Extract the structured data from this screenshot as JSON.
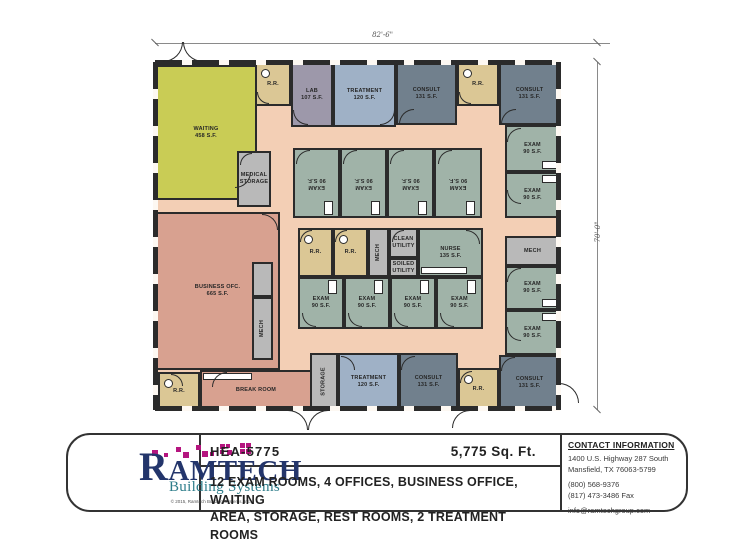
{
  "floor_plan": {
    "width_dimension": "82'-6\"",
    "height_dimension": "70'-0\"",
    "wall_color": "#2b2b2b",
    "palette": {
      "corridor": "#f3cfb5",
      "waiting": "#c9cc55",
      "office": "#d8a190",
      "exam": "#a0b3a8",
      "consult": "#71808d",
      "treatment": "#9fb1c6",
      "lab": "#9d98aa",
      "rr": "#dbc795",
      "util": "#b9b9b9"
    },
    "rooms": [
      {
        "id": "waiting",
        "type": "waiting",
        "label": [
          "WAITING",
          "458 S.F."
        ],
        "x": 155,
        "y": 65,
        "w": 102,
        "h": 135
      },
      {
        "id": "rr-entry",
        "type": "rr",
        "label": [
          "R.R."
        ],
        "x": 255,
        "y": 62,
        "w": 36,
        "h": 44,
        "fix": "wc"
      },
      {
        "id": "lab",
        "type": "lab",
        "label": [
          "LAB",
          "107 S.F."
        ],
        "x": 291,
        "y": 62,
        "w": 42,
        "h": 65
      },
      {
        "id": "treatment-top",
        "type": "treatment",
        "label": [
          "TREATMENT",
          "120 S.F."
        ],
        "x": 333,
        "y": 62,
        "w": 63,
        "h": 65
      },
      {
        "id": "consult-top-1",
        "type": "consult",
        "label": [
          "CONSULT",
          "131 S.F."
        ],
        "x": 396,
        "y": 62,
        "w": 61,
        "h": 63
      },
      {
        "id": "rr-top",
        "type": "rr",
        "label": [
          "R.R."
        ],
        "x": 457,
        "y": 62,
        "w": 42,
        "h": 44,
        "fix": "wc"
      },
      {
        "id": "consult-top-2",
        "type": "consult",
        "label": [
          "CONSULT",
          "131 S.F."
        ],
        "x": 499,
        "y": 62,
        "w": 61,
        "h": 63
      },
      {
        "id": "exam-right-1",
        "type": "exam",
        "label": [
          "EXAM",
          "90 S.F."
        ],
        "x": 505,
        "y": 125,
        "w": 55,
        "h": 47,
        "fix": "br"
      },
      {
        "id": "exam-right-2",
        "type": "exam",
        "label": [
          "EXAM",
          "90 S.F."
        ],
        "x": 505,
        "y": 172,
        "w": 55,
        "h": 46,
        "fix": "tr"
      },
      {
        "id": "mech-right",
        "type": "util",
        "label": [
          "MECH"
        ],
        "x": 505,
        "y": 236,
        "w": 55,
        "h": 30
      },
      {
        "id": "exam-right-3",
        "type": "exam",
        "label": [
          "EXAM",
          "90 S.F."
        ],
        "x": 505,
        "y": 266,
        "w": 55,
        "h": 44,
        "fix": "br"
      },
      {
        "id": "exam-right-4",
        "type": "exam",
        "label": [
          "EXAM",
          "90 S.F."
        ],
        "x": 505,
        "y": 310,
        "w": 55,
        "h": 45,
        "fix": "tr"
      },
      {
        "id": "consult-bottom-2",
        "type": "consult",
        "label": [
          "CONSULT",
          "131 S.F."
        ],
        "x": 499,
        "y": 355,
        "w": 61,
        "h": 55
      },
      {
        "id": "exam-1",
        "type": "exam",
        "label": [
          "EXAM",
          "90 S.F."
        ],
        "x": 293,
        "y": 148,
        "w": 47,
        "h": 70,
        "rot": 180,
        "fix": "bv"
      },
      {
        "id": "exam-2",
        "type": "exam",
        "label": [
          "EXAM",
          "90 S.F."
        ],
        "x": 340,
        "y": 148,
        "w": 47,
        "h": 70,
        "rot": 180,
        "fix": "bv"
      },
      {
        "id": "exam-3",
        "type": "exam",
        "label": [
          "EXAM",
          "90 S.F."
        ],
        "x": 387,
        "y": 148,
        "w": 47,
        "h": 70,
        "rot": 180,
        "fix": "bv"
      },
      {
        "id": "exam-4",
        "type": "exam",
        "label": [
          "EXAM",
          "90 S.F."
        ],
        "x": 434,
        "y": 148,
        "w": 48,
        "h": 70,
        "rot": 180,
        "fix": "bv"
      },
      {
        "id": "rr-core-1",
        "type": "rr",
        "label": [
          "R.R."
        ],
        "x": 298,
        "y": 228,
        "w": 35,
        "h": 49,
        "fix": "wc"
      },
      {
        "id": "rr-core-2",
        "type": "rr",
        "label": [
          "R.R."
        ],
        "x": 333,
        "y": 228,
        "w": 35,
        "h": 49,
        "fix": "wc"
      },
      {
        "id": "mech-core",
        "type": "util",
        "label": [
          "MECH"
        ],
        "x": 368,
        "y": 228,
        "w": 21,
        "h": 49,
        "rot": -90
      },
      {
        "id": "clean-utility",
        "type": "util",
        "label": [
          "CLEAN",
          "UTILITY"
        ],
        "x": 389,
        "y": 228,
        "w": 29,
        "h": 30
      },
      {
        "id": "soiled-utility",
        "type": "util",
        "label": [
          "SOILED",
          "UTILITY"
        ],
        "x": 389,
        "y": 258,
        "w": 29,
        "h": 19
      },
      {
        "id": "nurse",
        "type": "exam",
        "label": [
          "NURSE",
          "135 S.F."
        ],
        "x": 418,
        "y": 228,
        "w": 65,
        "h": 49,
        "fix": "cb"
      },
      {
        "id": "exam-5",
        "type": "exam",
        "label": [
          "EXAM",
          "90 S.F."
        ],
        "x": 298,
        "y": 277,
        "w": 46,
        "h": 52,
        "fix": "tv"
      },
      {
        "id": "exam-6",
        "type": "exam",
        "label": [
          "EXAM",
          "90 S.F."
        ],
        "x": 344,
        "y": 277,
        "w": 46,
        "h": 52,
        "fix": "tv"
      },
      {
        "id": "exam-7",
        "type": "exam",
        "label": [
          "EXAM",
          "90 S.F."
        ],
        "x": 390,
        "y": 277,
        "w": 46,
        "h": 52,
        "fix": "tv"
      },
      {
        "id": "exam-8",
        "type": "exam",
        "label": [
          "EXAM",
          "90 S.F."
        ],
        "x": 436,
        "y": 277,
        "w": 47,
        "h": 52,
        "fix": "tv"
      },
      {
        "id": "business-office",
        "type": "office",
        "label": [
          "BUSINESS OFC.",
          "665 S.F."
        ],
        "x": 155,
        "y": 212,
        "w": 125,
        "h": 158
      },
      {
        "id": "medical-storage",
        "type": "util",
        "label": [
          "MEDICAL",
          "STORAGE"
        ],
        "x": 237,
        "y": 151,
        "w": 34,
        "h": 56
      },
      {
        "id": "util-closet",
        "type": "util",
        "label": [],
        "x": 252,
        "y": 262,
        "w": 21,
        "h": 35
      },
      {
        "id": "mech-left",
        "type": "util",
        "label": [
          "MECH"
        ],
        "x": 252,
        "y": 297,
        "w": 21,
        "h": 63,
        "rot": -90
      },
      {
        "id": "rr-breakroom",
        "type": "rr",
        "label": [
          "R.R."
        ],
        "x": 158,
        "y": 372,
        "w": 42,
        "h": 38,
        "fix": "wc"
      },
      {
        "id": "break-room",
        "type": "office",
        "label": [
          "BREAK ROOM"
        ],
        "x": 200,
        "y": 370,
        "w": 112,
        "h": 40,
        "fix": "ct"
      },
      {
        "id": "storage-bottom",
        "type": "util",
        "label": [
          "STORAGE"
        ],
        "x": 310,
        "y": 353,
        "w": 28,
        "h": 57,
        "rot": -90
      },
      {
        "id": "treatment-bottom",
        "type": "treatment",
        "label": [
          "TREATMENT",
          "120 S.F."
        ],
        "x": 338,
        "y": 353,
        "w": 61,
        "h": 57
      },
      {
        "id": "consult-bottom-1",
        "type": "consult",
        "label": [
          "CONSULT",
          "131 S.F."
        ],
        "x": 399,
        "y": 353,
        "w": 59,
        "h": 57
      },
      {
        "id": "rr-bottom",
        "type": "rr",
        "label": [
          "R.R."
        ],
        "x": 458,
        "y": 368,
        "w": 41,
        "h": 42,
        "fix": "wc"
      }
    ]
  },
  "title_block": {
    "model": "HEA-5775",
    "square_footage": "5,775 Sq. Ft.",
    "description_line1": "12 EXAM ROOMS, 4 OFFICES, BUSINESS OFFICE, WAITING",
    "description_line2": "AREA, STORAGE, REST ROOMS, 2 TREATMENT ROOMS"
  },
  "logo": {
    "name": "RAMTECH",
    "tagline": "Building Systems",
    "copyright": "© 2015, Ramtech Building Systems, Inc.",
    "brand_navy": "#23356b",
    "brand_teal": "#2d7d8a",
    "brand_magenta": "#b5157f"
  },
  "contact": {
    "heading": "CONTACT INFORMATION",
    "address_line1": "1400 U.S. Highway 287 South",
    "address_line2": "Mansfield, TX  76063-5799",
    "phone": "(800) 568-9376",
    "fax": "(817) 473-3486 Fax",
    "email": "info@ramtechgroup.com"
  }
}
